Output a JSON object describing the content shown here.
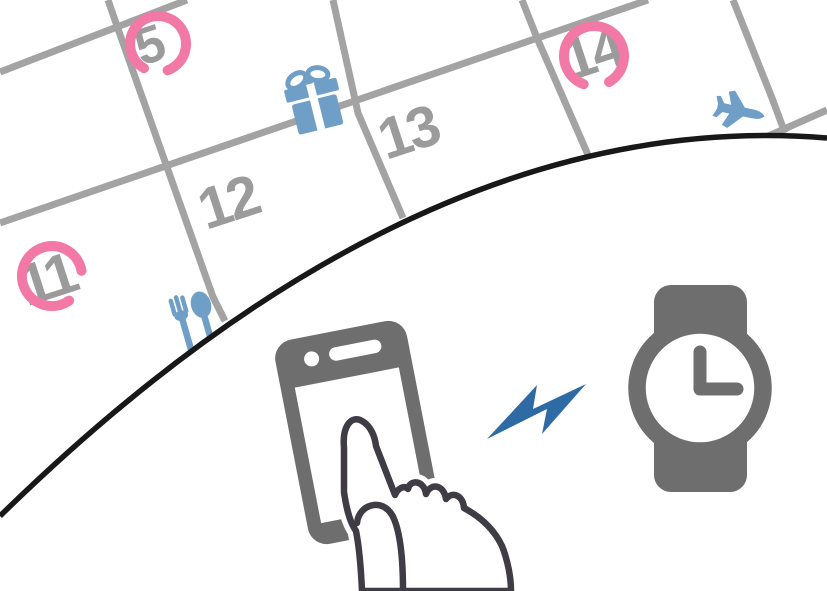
{
  "illustration": {
    "kind": "calendar-phone-watch-sync-illustration",
    "calendar": {
      "dates": [
        {
          "day": "5",
          "circled": true,
          "event_icon": "gift-icon"
        },
        {
          "day": "11",
          "circled": true,
          "event_icon": "cutlery-icon"
        },
        {
          "day": "12",
          "circled": false,
          "event_icon": null
        },
        {
          "day": "13",
          "circled": false,
          "event_icon": null
        },
        {
          "day": "14",
          "circled": true,
          "event_icon": "airplane-icon"
        }
      ],
      "grid_color": "#a3a3a3",
      "number_color": "#9b9b9b",
      "circle_color": "#f279a5",
      "event_icon_color": "#6f9fc6"
    },
    "foreground": {
      "icons": [
        "smartphone-icon",
        "touching-hand-icon",
        "lightning-bolt-icon",
        "wristwatch-icon"
      ],
      "watch_time_shown": "3:00",
      "device_color": "#6e6e6e",
      "hand_outline_color": "#3f3c45",
      "bolt_color": "#2e6ba4",
      "page_curve_color": "#181818"
    }
  }
}
